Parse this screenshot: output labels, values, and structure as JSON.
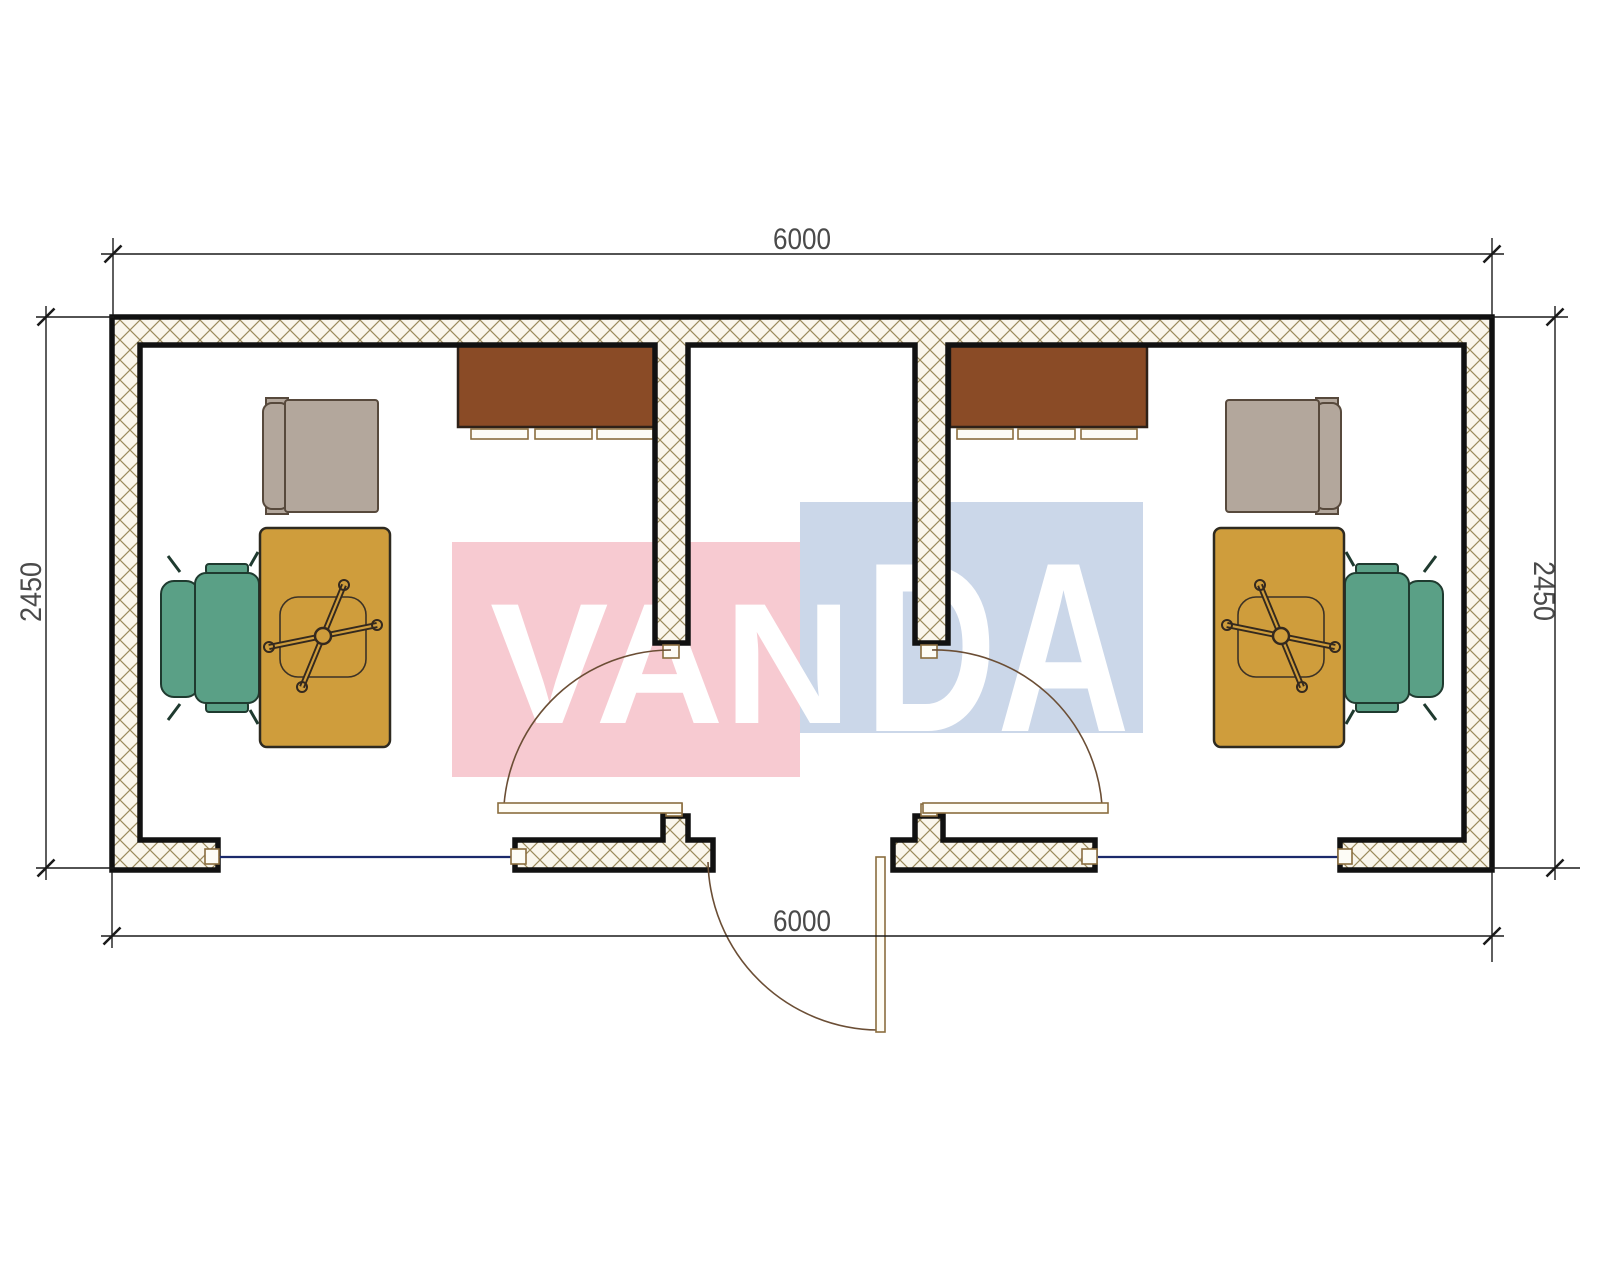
{
  "dimensions": {
    "top": "6000",
    "bottom": "6000",
    "left": "2450",
    "right": "2450"
  },
  "watermark": {
    "brand": "VANDA",
    "segment_left": "VAN",
    "segment_right": "DA",
    "pink_block": "#f7cad1",
    "blue_block": "#cbd7e9",
    "text_color": "#ffffff"
  },
  "colors": {
    "wall_fill": "#faf6ec",
    "wall_hatch": "#9b8a5c",
    "wall_line": "#111111",
    "cabinet": "#8a4b26",
    "desk": "#cf9d3c",
    "chair_green": "#5aa086",
    "armchair_gray": "#b3a79c",
    "window_glass": "#1b2a6b",
    "door_arc": "#6b4e35",
    "dim_text": "#4a4a4a"
  }
}
